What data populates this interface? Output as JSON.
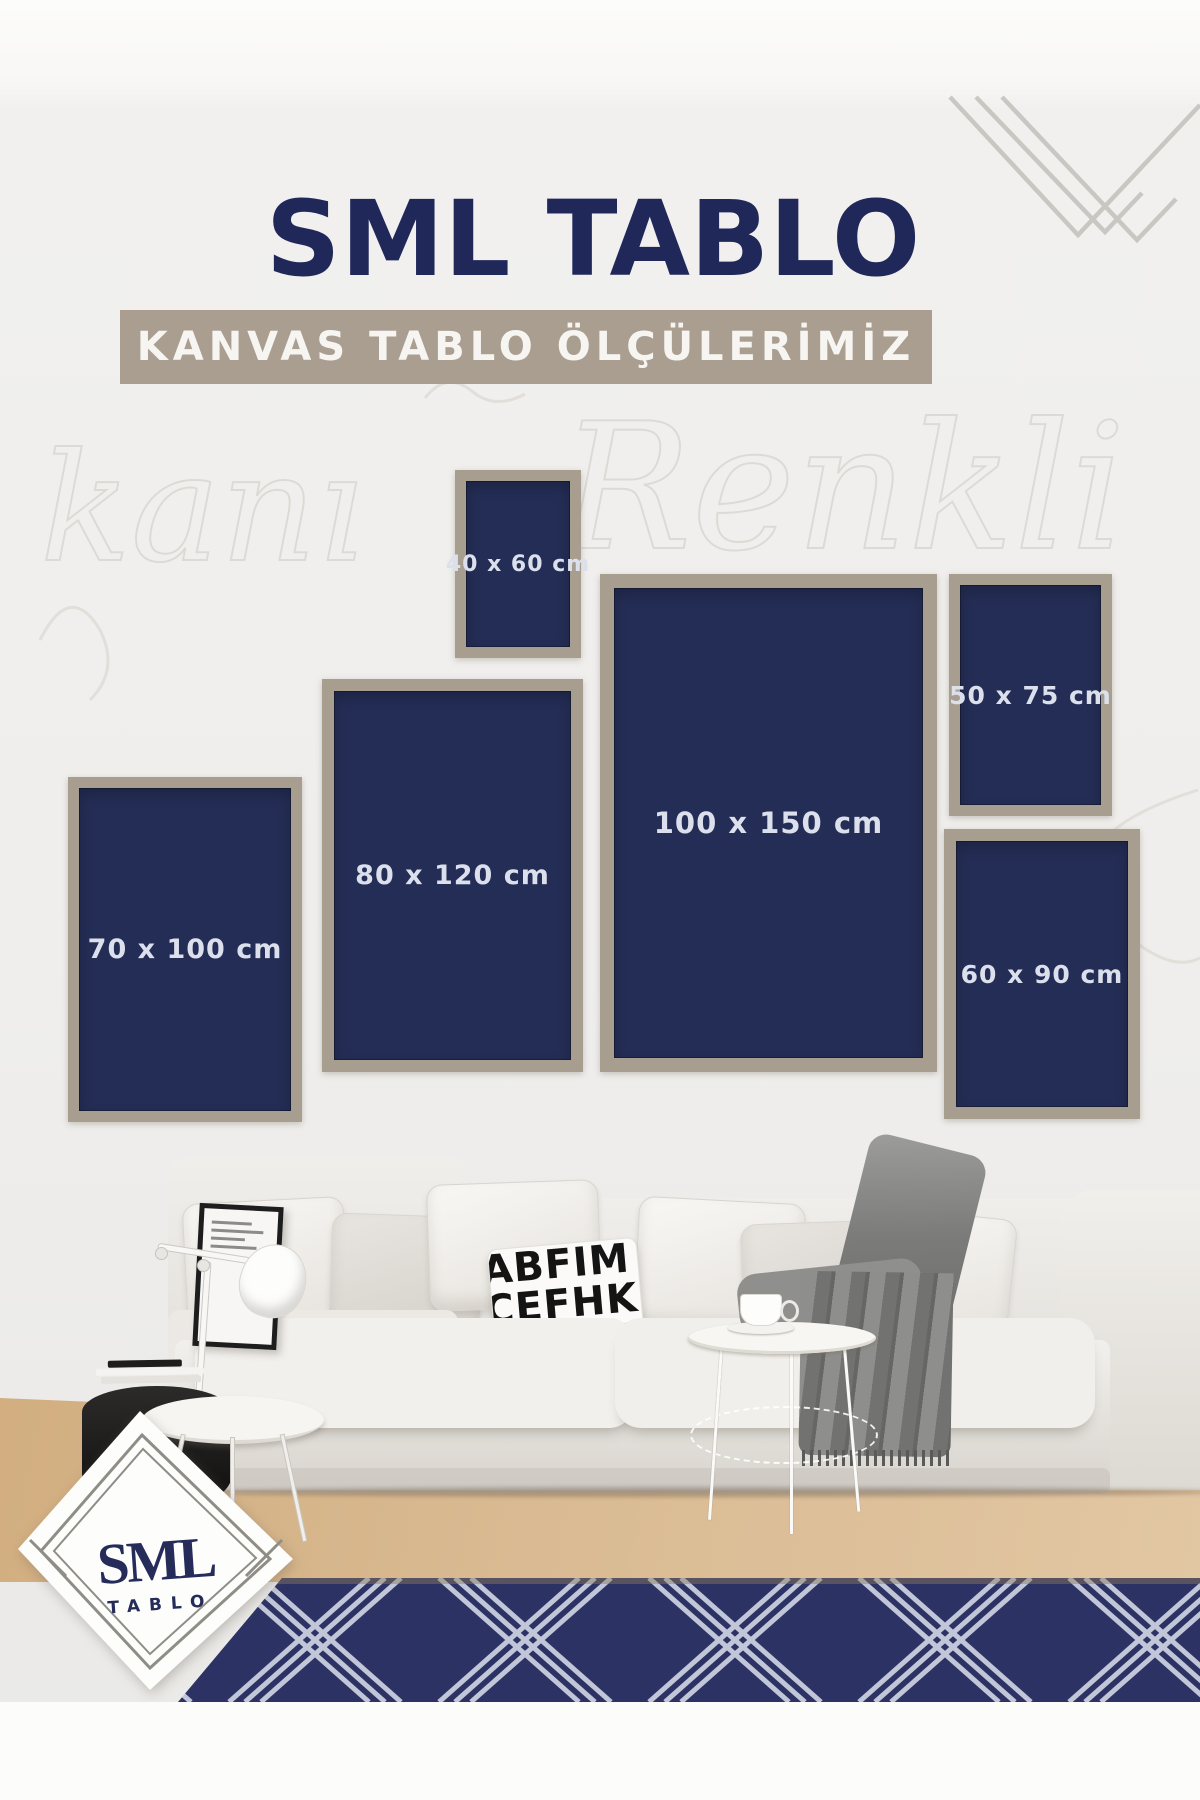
{
  "header": {
    "title": "SML TABLO",
    "subtitle": "KANVAS TABLO ÖLÇÜLERİMİZ"
  },
  "frames": [
    {
      "size": "40x60",
      "label": "40 x 60 cm"
    },
    {
      "size": "50x75",
      "label": "50 x 75 cm"
    },
    {
      "size": "100x150",
      "label": "100 x 150 cm"
    },
    {
      "size": "80x120",
      "label": "80 x 120 cm"
    },
    {
      "size": "70x100",
      "label": "70 x 100 cm"
    },
    {
      "size": "60x90",
      "label": "60 x 90 cm"
    }
  ],
  "logo": {
    "brand": "SML",
    "sub": "TABLO"
  },
  "watermarks": {
    "w1": "Renkli",
    "w2": "kanı"
  },
  "pillow_letters": {
    "row1": "ABFIM",
    "row2": "CEFHK",
    "row3": "DOHLS"
  },
  "colors": {
    "title_navy": "#20285a",
    "banner_taupe": "#a99e90",
    "frame_border_taupe": "#a89e8f",
    "canvas_navy": "#242d55",
    "rug_navy": "#2c3263",
    "rug_line": "#c9cedf",
    "wall": "#efeeec",
    "floor_tan": "#d9ba92"
  }
}
